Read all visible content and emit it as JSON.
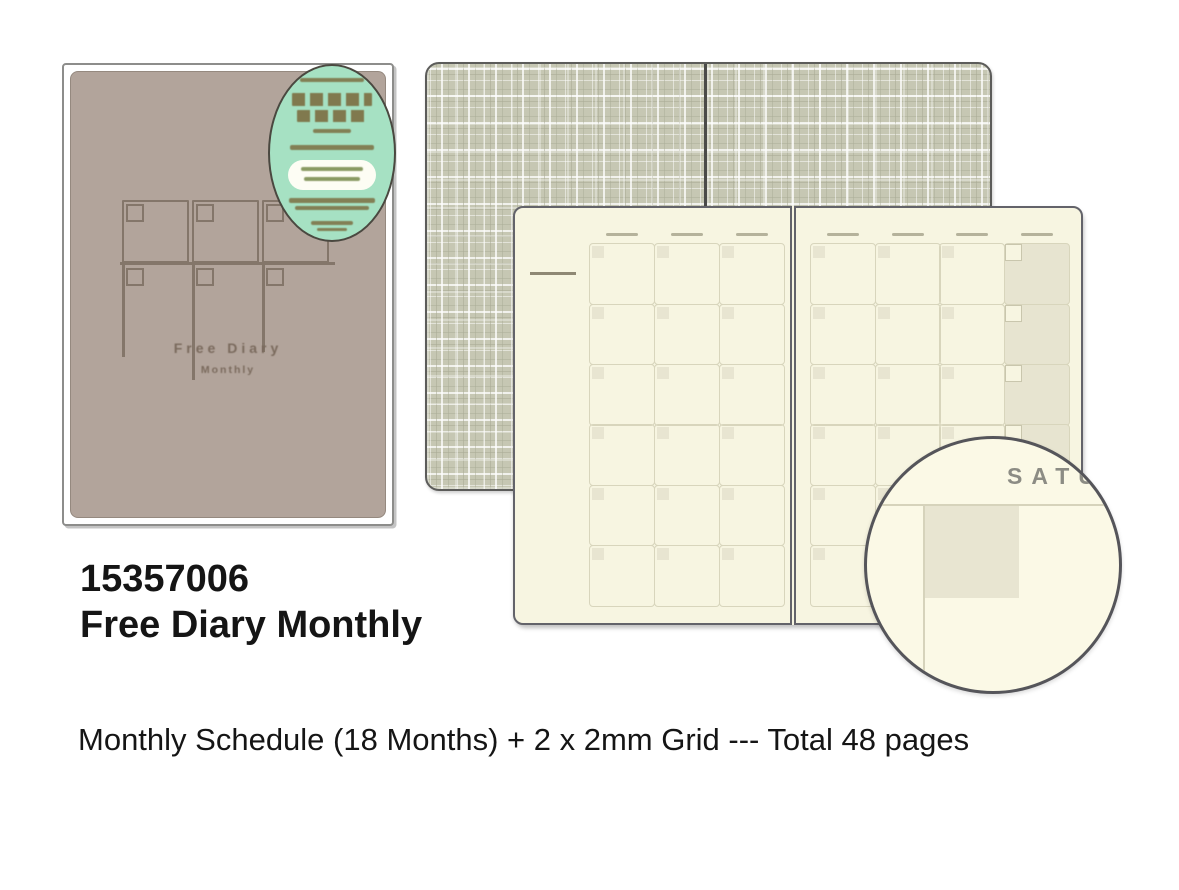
{
  "product": {
    "number": "15357006",
    "name": "Free Diary Monthly",
    "description": "Monthly Schedule (18 Months) + 2 x 2mm Grid --- Total 48 pages"
  },
  "cover": {
    "title": "Free Diary",
    "subtitle": "Monthly"
  },
  "calendar_spread": {
    "left_page": {
      "columns": 3,
      "rows": 6,
      "shaded_last_column": false
    },
    "right_page": {
      "columns": 4,
      "rows": 6,
      "shaded_last_column": true
    }
  },
  "magnifier": {
    "day_label": "SATU"
  },
  "theme": {
    "cover_color": "#b2a49b",
    "cover_line": "#84766a",
    "cover_text": "#7a6a5d",
    "sticker_fill": "#a6e1c3",
    "sticker_border": "#4a4840",
    "page_cream": "#f7f5e1",
    "grid_line": "#d8d5bc",
    "cell_corner": "#e8e5d1",
    "shaded_cell": "#e7e4d0",
    "page_border": "#63636a",
    "plaid_base": "#c6c7b3",
    "magnifier_fill": "#fbf9e6",
    "mag_text": "#8c8c84",
    "ink": "#151515"
  }
}
